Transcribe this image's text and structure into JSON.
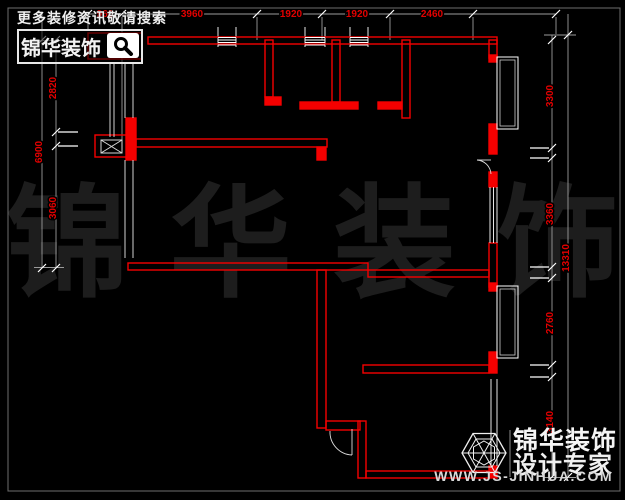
{
  "header": {
    "promo_text": "更多装修资讯敬请搜索",
    "logo_text": "锦华装饰"
  },
  "watermark": {
    "char1": "锦",
    "char2": "华",
    "char3": "装",
    "char4": "饰"
  },
  "dimensions": {
    "top": [
      "960",
      "3960",
      "1920",
      "1920",
      "2460"
    ],
    "left_inner": [
      "2820",
      "3060"
    ],
    "left_outer": "6900",
    "right_inner": [
      "3300",
      "3360",
      "2760",
      "3140"
    ],
    "right_outer": "13310"
  },
  "footer": {
    "brand": "锦华装饰",
    "tagline": "设计专家",
    "website": "WWW.JS-JINHUA.COM"
  },
  "colors": {
    "wall": "#f40000",
    "window": "#ffffff",
    "dimension_line": "#9b9b9b",
    "dimension_text": "#e20000",
    "background": "#000000"
  }
}
